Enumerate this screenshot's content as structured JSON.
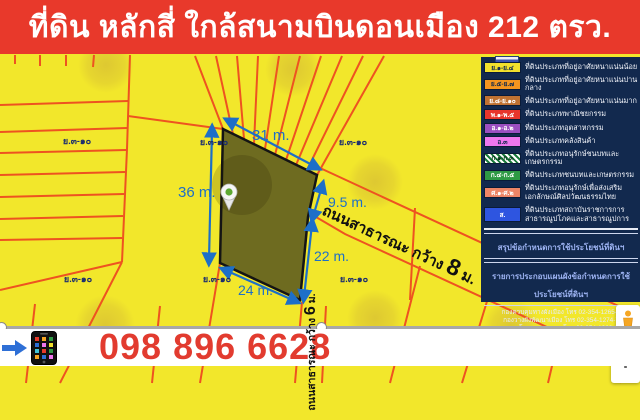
{
  "header": {
    "title": "ที่ดิน หลักสี่ ใกล้สนามบินดอนเมือง 212 ตรว.",
    "bg_color": "#e8392b"
  },
  "map": {
    "zone_label": "ย.๓-๑๐",
    "measurements": {
      "top": "31 m.",
      "left": "36 m.",
      "upper_right": "9.5 m.",
      "right": "22 m.",
      "bottom": "24 m."
    },
    "roads": {
      "road8": {
        "prefix": "ถนนสาธารณะ กว้าง ",
        "number": "8",
        "suffix": " ม."
      },
      "road6": {
        "prefix": "ถนนสาธารณะ กว้าง ",
        "number": "6",
        "suffix": " ม."
      }
    },
    "colors": {
      "map_bg": "#f2e72b",
      "parcel_line": "#ee5320",
      "plot_fill": "#6e6b20",
      "measure_blue": "#1d6fc8"
    }
  },
  "legend": {
    "items": [
      {
        "code": "ย.๑-ย.๔",
        "label": "ที่ดินประเภทที่อยู่อาศัยหนาแน่นน้อย",
        "color": "#f2e02c",
        "pattern": "solid"
      },
      {
        "code": "ย.๕-ย.๗",
        "label": "ที่ดินประเภทที่อยู่อาศัยหนาแน่นปานกลาง",
        "color": "#f5951f",
        "pattern": "solid"
      },
      {
        "code": "ย.๘-ย.๑๐",
        "label": "ที่ดินประเภทที่อยู่อาศัยหนาแน่นมาก",
        "color": "#bf7232",
        "pattern": "solid"
      },
      {
        "code": "พ.๑-พ.๕",
        "label": "ที่ดินประเภทพาณิชยกรรม",
        "color": "#e8352b",
        "pattern": "solid"
      },
      {
        "code": "อ.๑-อ.๒",
        "label": "ที่ดินประเภทอุตสาหกรรม",
        "color": "#9b4fc1",
        "pattern": "solid"
      },
      {
        "code": "อ.๓",
        "label": "ที่ดินประเภทคลังสินค้า",
        "color": "#ee77ee",
        "pattern": "solid"
      },
      {
        "code": "ก.๑-ก.๓",
        "label": "ที่ดินประเภทอนุรักษ์ชนบทและเกษตรกรรม",
        "color": "#ffffff",
        "pattern": "hatch"
      },
      {
        "code": "ก.๔-ก.๕",
        "label": "ที่ดินประเภทชนบทและเกษตรกรรม",
        "color": "#2e9a44",
        "pattern": "solid"
      },
      {
        "code": "ศ.๑-ศ.๒",
        "label": "ที่ดินประเภทอนุรักษ์เพื่อส่งเสริมเอกลักษณ์ศิลปวัฒนธรรมไทย",
        "color": "#ee8566",
        "pattern": "solid"
      },
      {
        "code": "ส.",
        "label": "ที่ดินประเภทสถาบันราชการการสาธารณูปโภคและสาธารณูปการ",
        "color": "#2e55e0",
        "pattern": "solid"
      }
    ],
    "banners": [
      "สรุปข้อกำหนดการใช้ประโยชน์ที่ดินฯ",
      "รายการประกอบแผนผังข้อกำหนดการใช้ประโยชน์ที่ดินฯ"
    ],
    "contacts": [
      "กองควบคุมทางผังเมือง โทร 02-354-1265-7",
      "กองวางผังพัฒนาเมือง โทร 02-354-1274-7",
      "กองนโยบายและแผน โทร 02-354-1262-6",
      "กองสำรวจและแผนที่ โทร 02-354-1268-72",
      "กองจัดการรูปที่ดินและปรับปรุงฟื้นฟูเมือง โทร 02-354-1268-72"
    ],
    "contacts_footer": {
      "pre": "สำนักผังเมือง กทม. ",
      "or": "หรือ",
      "post": " GIS ตรวจสอบการใช้ประโยชน์ที่ดิน กทม."
    }
  },
  "controls": {
    "zoom_in": "+"
  },
  "footer": {
    "phone": "098 896 6628",
    "phone_color": "#e23b2f"
  }
}
